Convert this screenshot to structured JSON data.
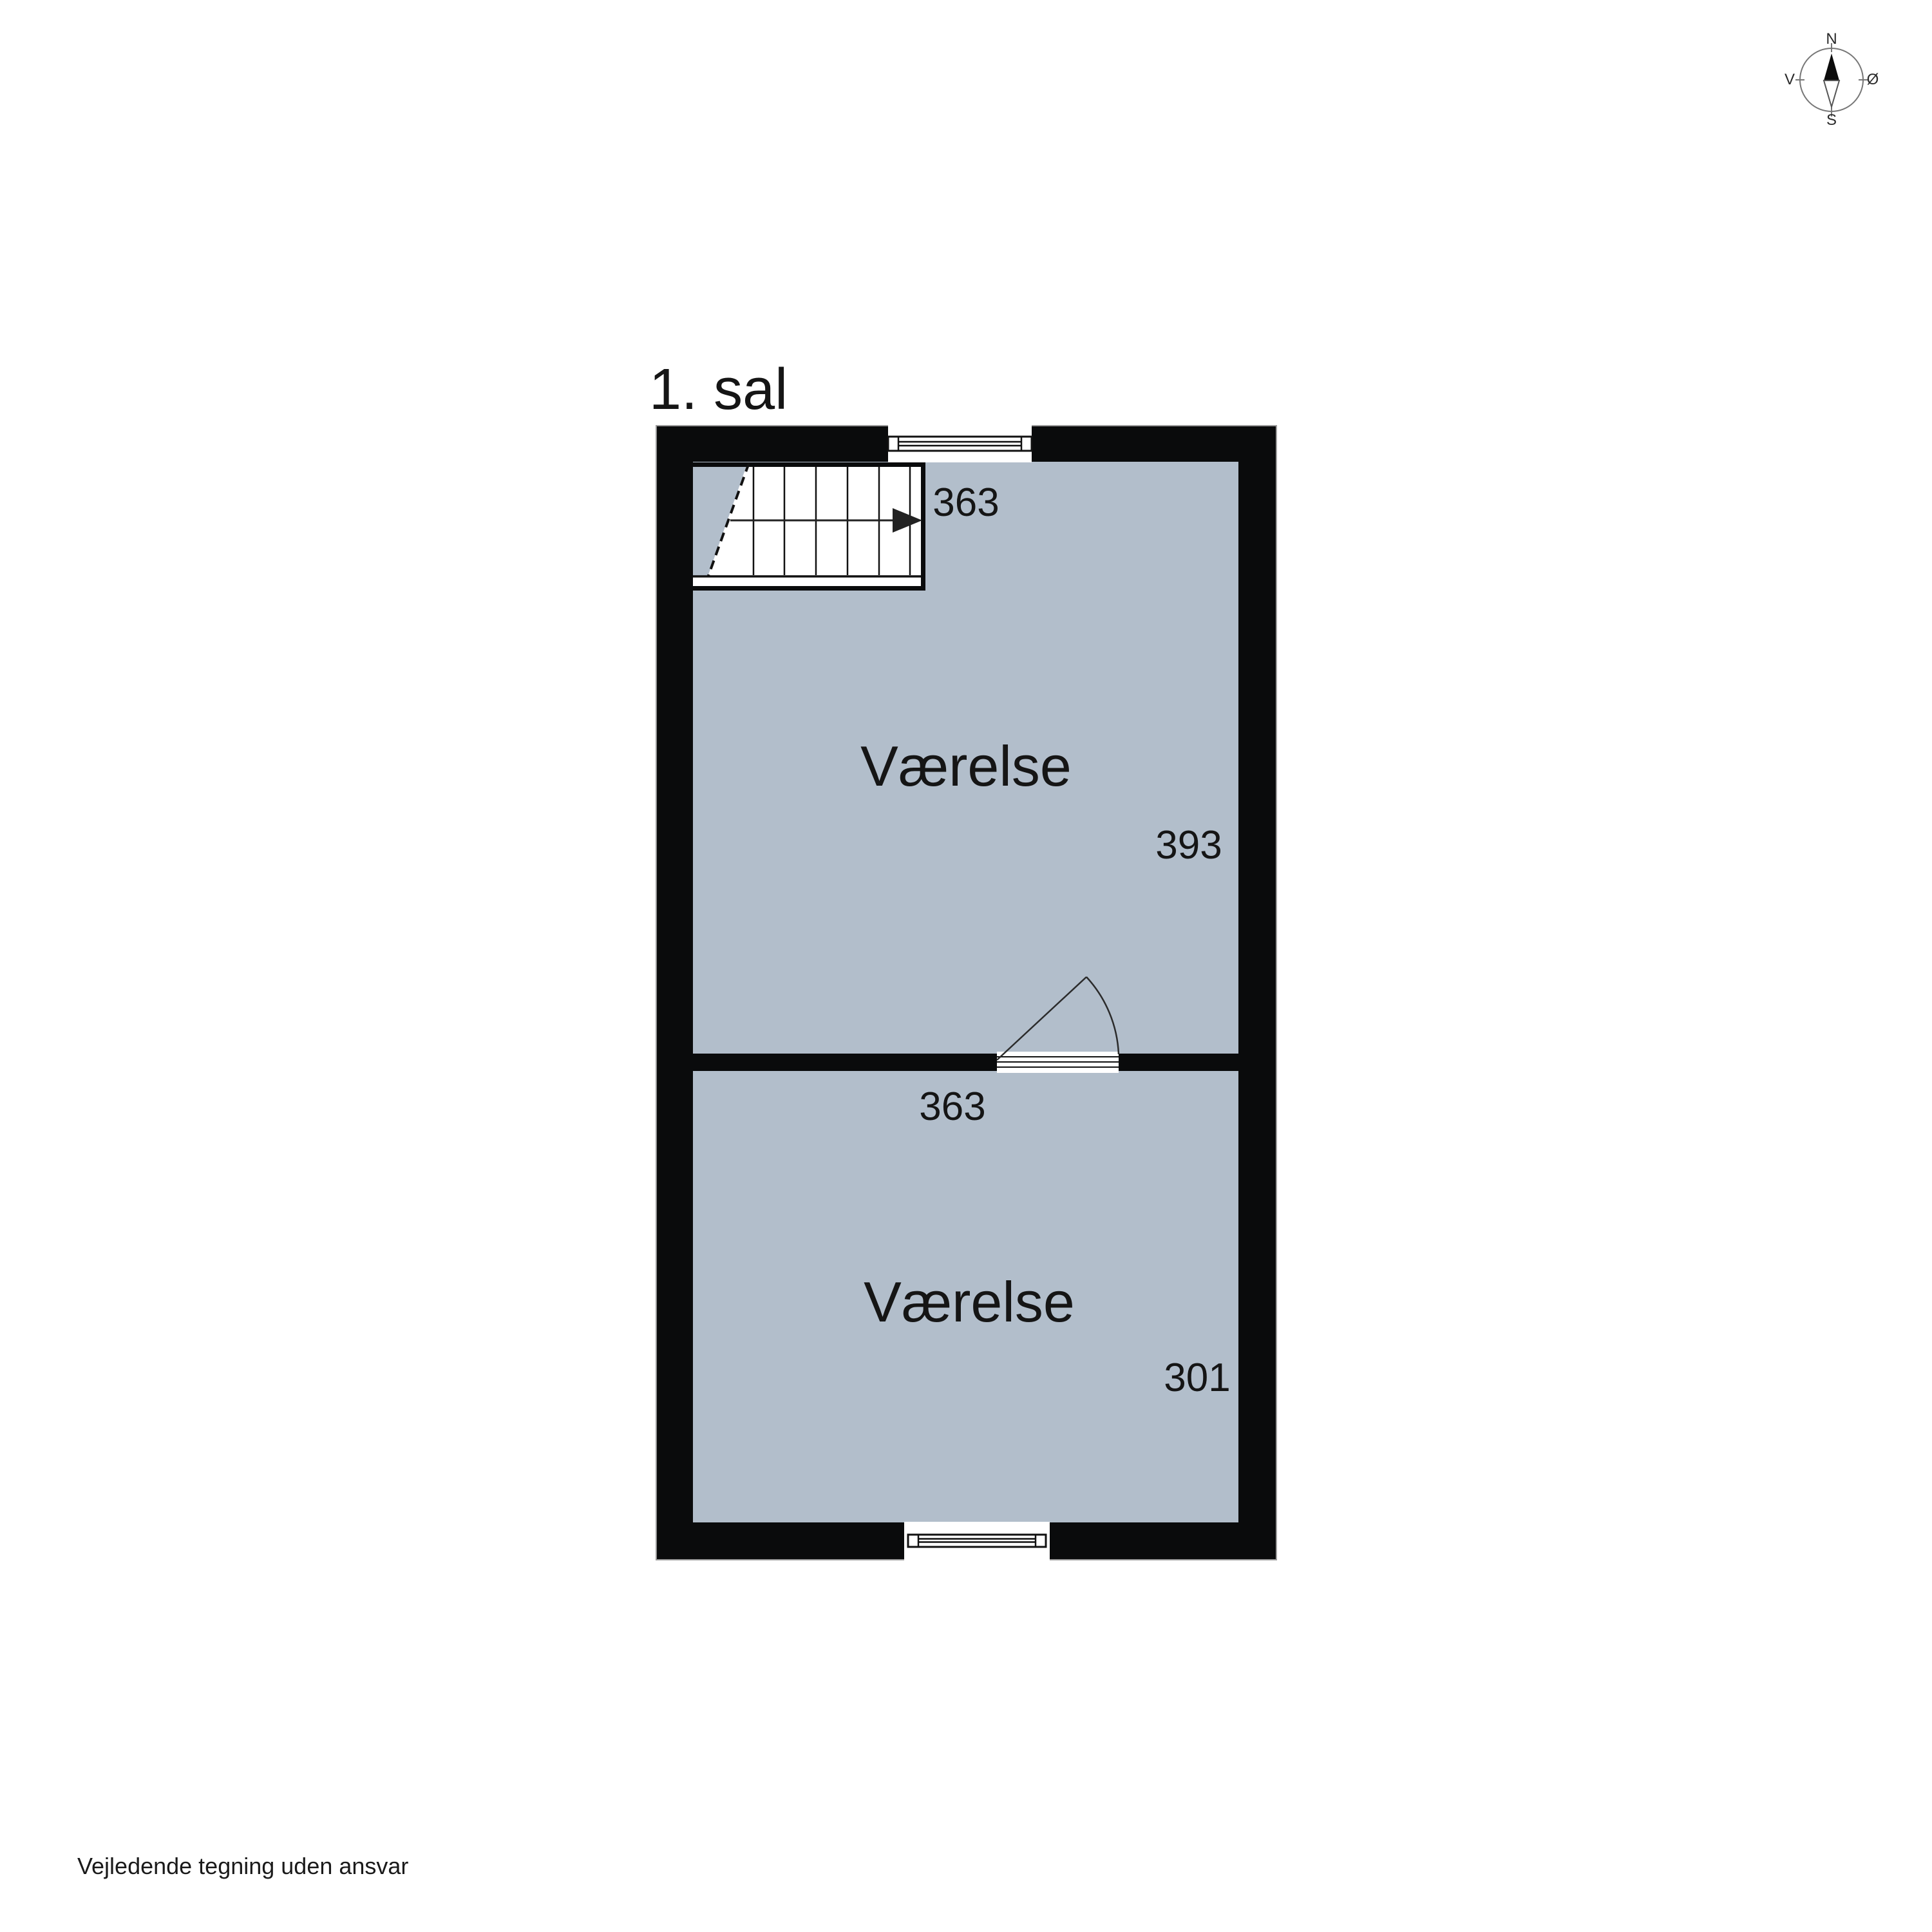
{
  "title": "1. sal",
  "rooms": [
    {
      "name": "Værelse",
      "dim_width": "363",
      "dim_depth": "393"
    },
    {
      "name": "Værelse",
      "dim_width": "363",
      "dim_depth": "301"
    }
  ],
  "compass": {
    "north": "N",
    "east": "Ø",
    "south": "S",
    "west": "V"
  },
  "footer": {
    "disclaimer": "Vejledende tegning uden ansvar"
  },
  "colors": {
    "wall": "#0a0b0c",
    "floor": "#b2becb",
    "outline": "#9b9b9b",
    "ink": "#151515"
  }
}
